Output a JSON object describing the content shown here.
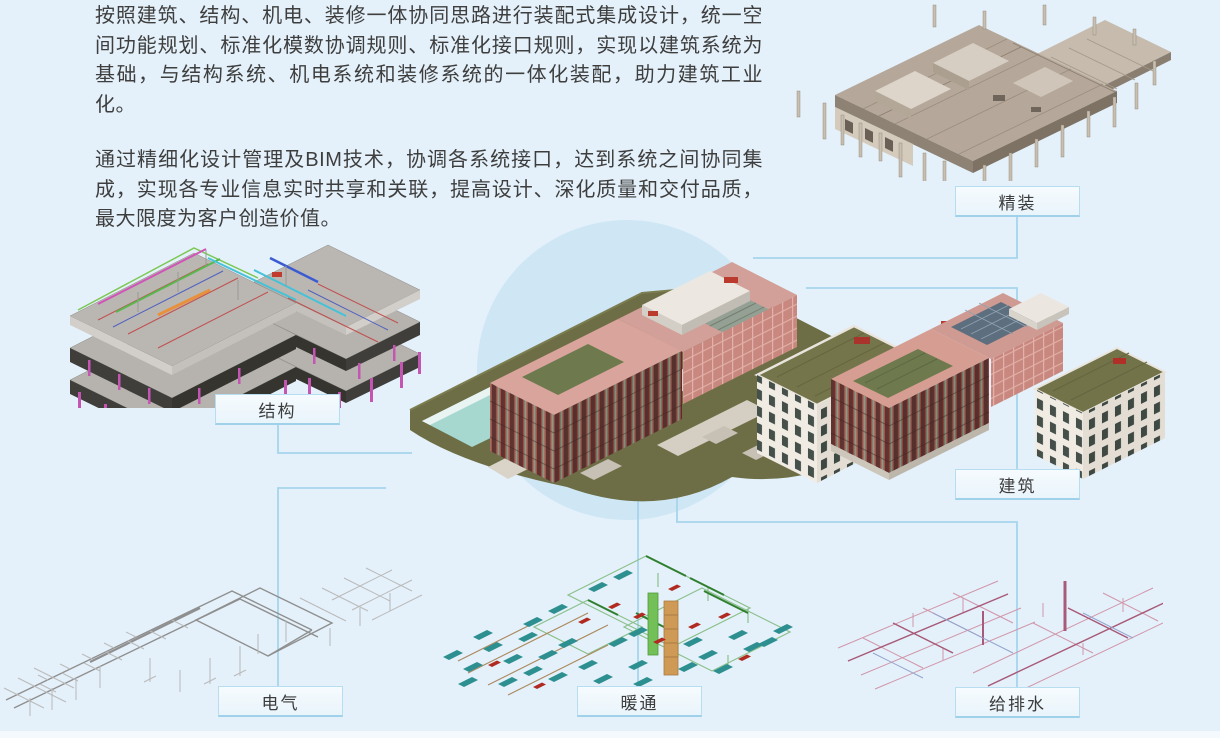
{
  "intro": {
    "p1": "按照建筑、结构、机电、装修一体协同思路进行装配式集成设计，统一空间功能规划、标准化模数协调规则、标准化接口规则，实现以建筑系统为基础，与结构系统、机电系统和装修系统的一体化装配，助力建筑工业化。",
    "p2": "通过精细化设计管理及BIM技术，协调各系统接口，达到系统之间协同集成，实现各专业信息实时共享和关联，提高设计、深化质量和交付品质，最大限度为客户创造价值。"
  },
  "diagram": {
    "nodes": [
      {
        "id": "jingzhuang",
        "label": "精装"
      },
      {
        "id": "jiegou",
        "label": "结构"
      },
      {
        "id": "jianzhu",
        "label": "建筑"
      },
      {
        "id": "dianqi",
        "label": "电气"
      },
      {
        "id": "nuantong",
        "label": "暖通"
      },
      {
        "id": "geipaishui",
        "label": "给排水"
      }
    ]
  },
  "colors": {
    "background": "#e4f1fa",
    "halo": "#cfe7f5",
    "connector": "#a6d5ec",
    "label_box_bg": "#eff8fc",
    "label_box_border": "#b7ddf0",
    "text": "#3e3e3e"
  }
}
